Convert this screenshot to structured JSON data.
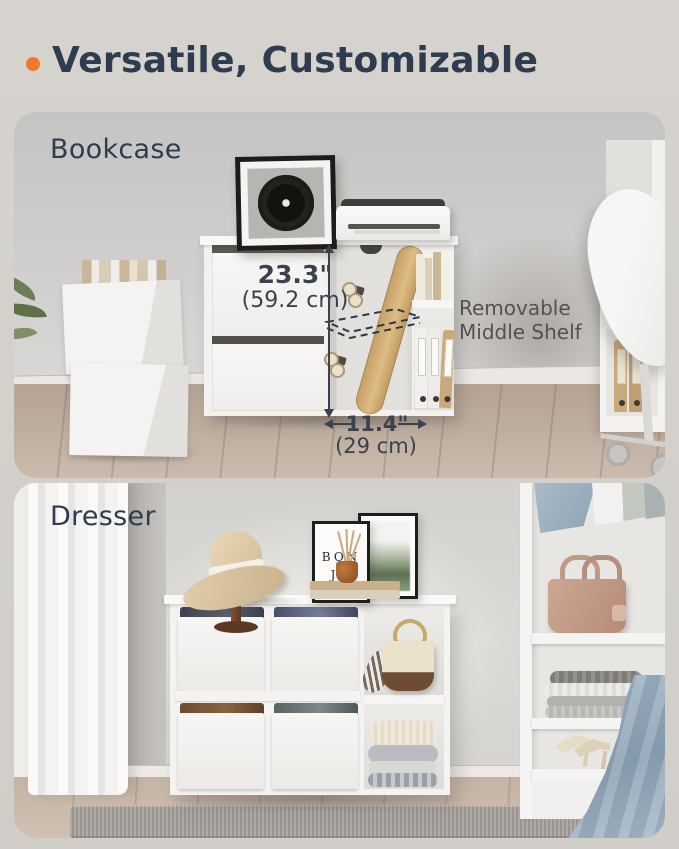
{
  "page": {
    "background_color": "#d3d0cb",
    "accent_orange": "#f0782a",
    "heading_color": "#2d3c4e",
    "dimension_color": "#39424d",
    "note_color": "#55514d"
  },
  "header": {
    "title": "Versatile, Customizable"
  },
  "bookcase_panel": {
    "label": "Bookcase",
    "dimensions": {
      "height_in": "23.3\"",
      "height_cm": "(59.2 cm)",
      "width_in": "11.4\"",
      "width_cm": "(29 cm)"
    },
    "annotation": {
      "line1": "Removable",
      "line2": "Middle Shelf"
    }
  },
  "dresser_panel": {
    "label": "Dresser",
    "frame_text": {
      "line1": "BON",
      "line2": "JO"
    }
  }
}
